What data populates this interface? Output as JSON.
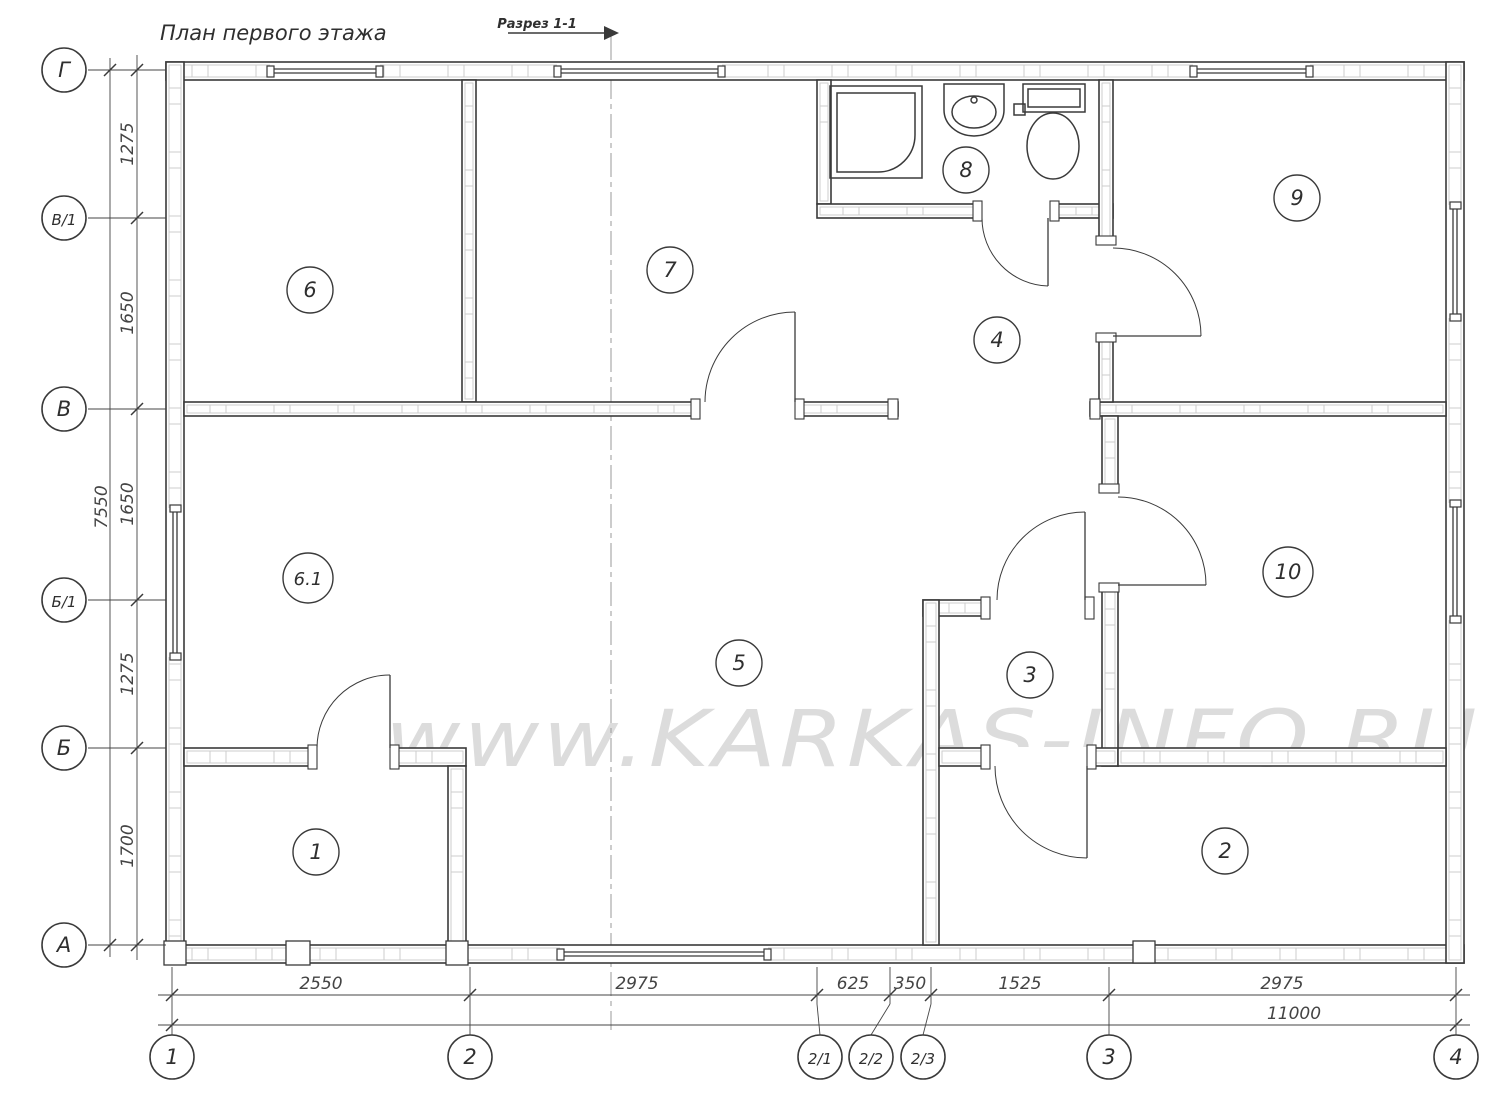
{
  "title": "План первого этажа",
  "section_mark": {
    "label": "Разрез 1-1"
  },
  "watermark": "www.KARKAS-INFO.RU",
  "colors": {
    "line": "#3a3a3a",
    "light": "#c9c9c9",
    "dim": "#444444",
    "watermark": "#dcdcdc",
    "text": "#2f2f2f"
  },
  "rooms": [
    {
      "number": "6",
      "x": 310,
      "y": 290
    },
    {
      "number": "7",
      "x": 670,
      "y": 270
    },
    {
      "number": "8",
      "x": 966,
      "y": 170
    },
    {
      "number": "9",
      "x": 1297,
      "y": 198
    },
    {
      "number": "4",
      "x": 997,
      "y": 340
    },
    {
      "number": "6.1",
      "x": 308,
      "y": 578
    },
    {
      "number": "5",
      "x": 739,
      "y": 663
    },
    {
      "number": "3",
      "x": 1030,
      "y": 675
    },
    {
      "number": "10",
      "x": 1288,
      "y": 572
    },
    {
      "number": "1",
      "x": 316,
      "y": 852
    },
    {
      "number": "2",
      "x": 1225,
      "y": 851
    }
  ],
  "axes": {
    "vertical": [
      {
        "label": "Г",
        "y": 70
      },
      {
        "label": "В/1",
        "y": 218
      },
      {
        "label": "В",
        "y": 409
      },
      {
        "label": "Б/1",
        "y": 600
      },
      {
        "label": "Б",
        "y": 748
      },
      {
        "label": "А",
        "y": 945
      }
    ],
    "horizontal": [
      {
        "label": "1",
        "x": 172,
        "cx": 172
      },
      {
        "label": "2",
        "x": 470,
        "cx": 470
      },
      {
        "label": "2/1",
        "x": 817,
        "cx": 820
      },
      {
        "label": "2/2",
        "x": 890,
        "cx": 871
      },
      {
        "label": "2/3",
        "x": 931,
        "cx": 923
      },
      {
        "label": "3",
        "x": 1109,
        "cx": 1109
      },
      {
        "label": "4",
        "x": 1456,
        "cx": 1456
      }
    ]
  },
  "dims": {
    "bottom_segments": [
      {
        "label": "2550",
        "x": 321
      },
      {
        "label": "2975",
        "x": 637
      },
      {
        "label": "625",
        "x": 853
      },
      {
        "label": "350",
        "x": 910
      },
      {
        "label": "1525",
        "x": 1020
      },
      {
        "label": "2975",
        "x": 1282
      }
    ],
    "bottom_overall": {
      "label": "11000",
      "x": 1294,
      "y": 1019
    },
    "left_segments": [
      {
        "label": "1275",
        "y": 144
      },
      {
        "label": "1650",
        "y": 313
      },
      {
        "label": "1650",
        "y": 504
      },
      {
        "label": "1275",
        "y": 674
      },
      {
        "label": "1700",
        "y": 846
      }
    ],
    "left_overall": {
      "label": "7550",
      "x": 107,
      "y": 507
    }
  }
}
